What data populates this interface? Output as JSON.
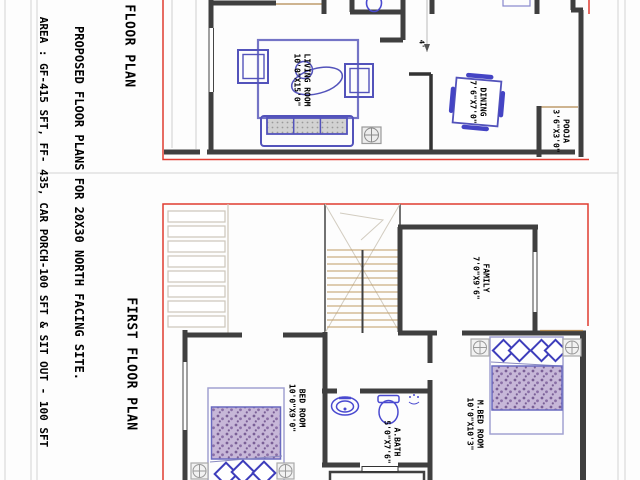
{
  "sheet": {
    "note_line1": "PROPOSED FLOOR PLANS FOR 20X30 NORTH FACING SITE.",
    "note_line2": "AREA : GF-415 SFT, FF- 435, CAR PORCH-100 SFT & SIT OUT - 100 SFT"
  },
  "ground_floor": {
    "title": "FLOOR PLAN",
    "dimension_label": "4'",
    "rooms": {
      "living": {
        "name": "LIVING ROOM",
        "size": "10'0\"X15'0\""
      },
      "dining": {
        "name": "DINING",
        "size": "7'6\"X7'0\""
      },
      "pooja": {
        "name": "POOJA",
        "size": "3'6\"X3'0\""
      }
    }
  },
  "first_floor": {
    "title": "FIRST FLOOR PLAN",
    "rooms": {
      "family": {
        "name": "FAMILY",
        "size": "7'0\"X9'6\""
      },
      "bed": {
        "name": "BED ROOM",
        "size": "10'0\"X9'0\""
      },
      "abath": {
        "name": "A.BATH",
        "size": "5'0\"X7'6\""
      },
      "mbed": {
        "name": "M.BED ROOM",
        "size": "10'0\"X10'3\""
      }
    }
  },
  "colors": {
    "site_boundary_red": "#e03c30",
    "wall_gray": "#3f3f3f",
    "furniture_blue": "#5353bb",
    "fixture_blue": "#4a4ad0",
    "blanket_purple": "#c3b2d6",
    "tread_tan": "#c09a62",
    "frame_gray": "#d4d4d4"
  }
}
